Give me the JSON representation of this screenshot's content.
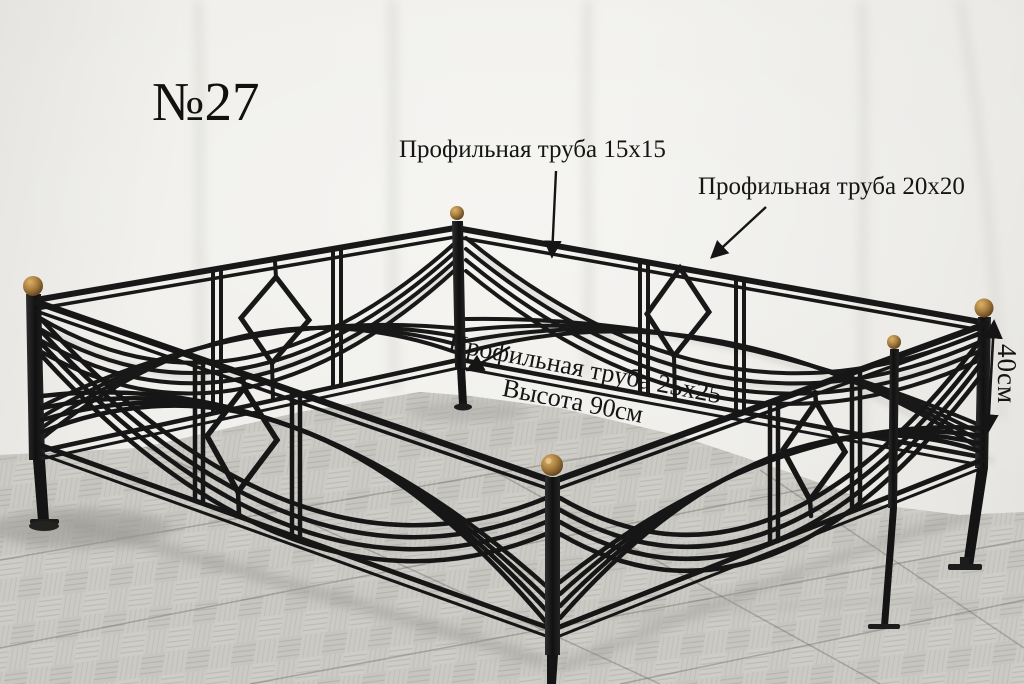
{
  "photo": {
    "product_label": "№27",
    "callout_tube15": "Профильная труба 15х15",
    "callout_tube20": "Профильная труба 20х20",
    "callout_tube25_line1": "Профильная труба 25х25",
    "callout_tube25_line2": "Высота 90см",
    "callout_section_height": "40см",
    "colors": {
      "wall": "#edece8",
      "floor": "#cbcac4",
      "metal": "#1b1b1b",
      "brass": "#a87e3f",
      "ink": "#141414"
    }
  }
}
